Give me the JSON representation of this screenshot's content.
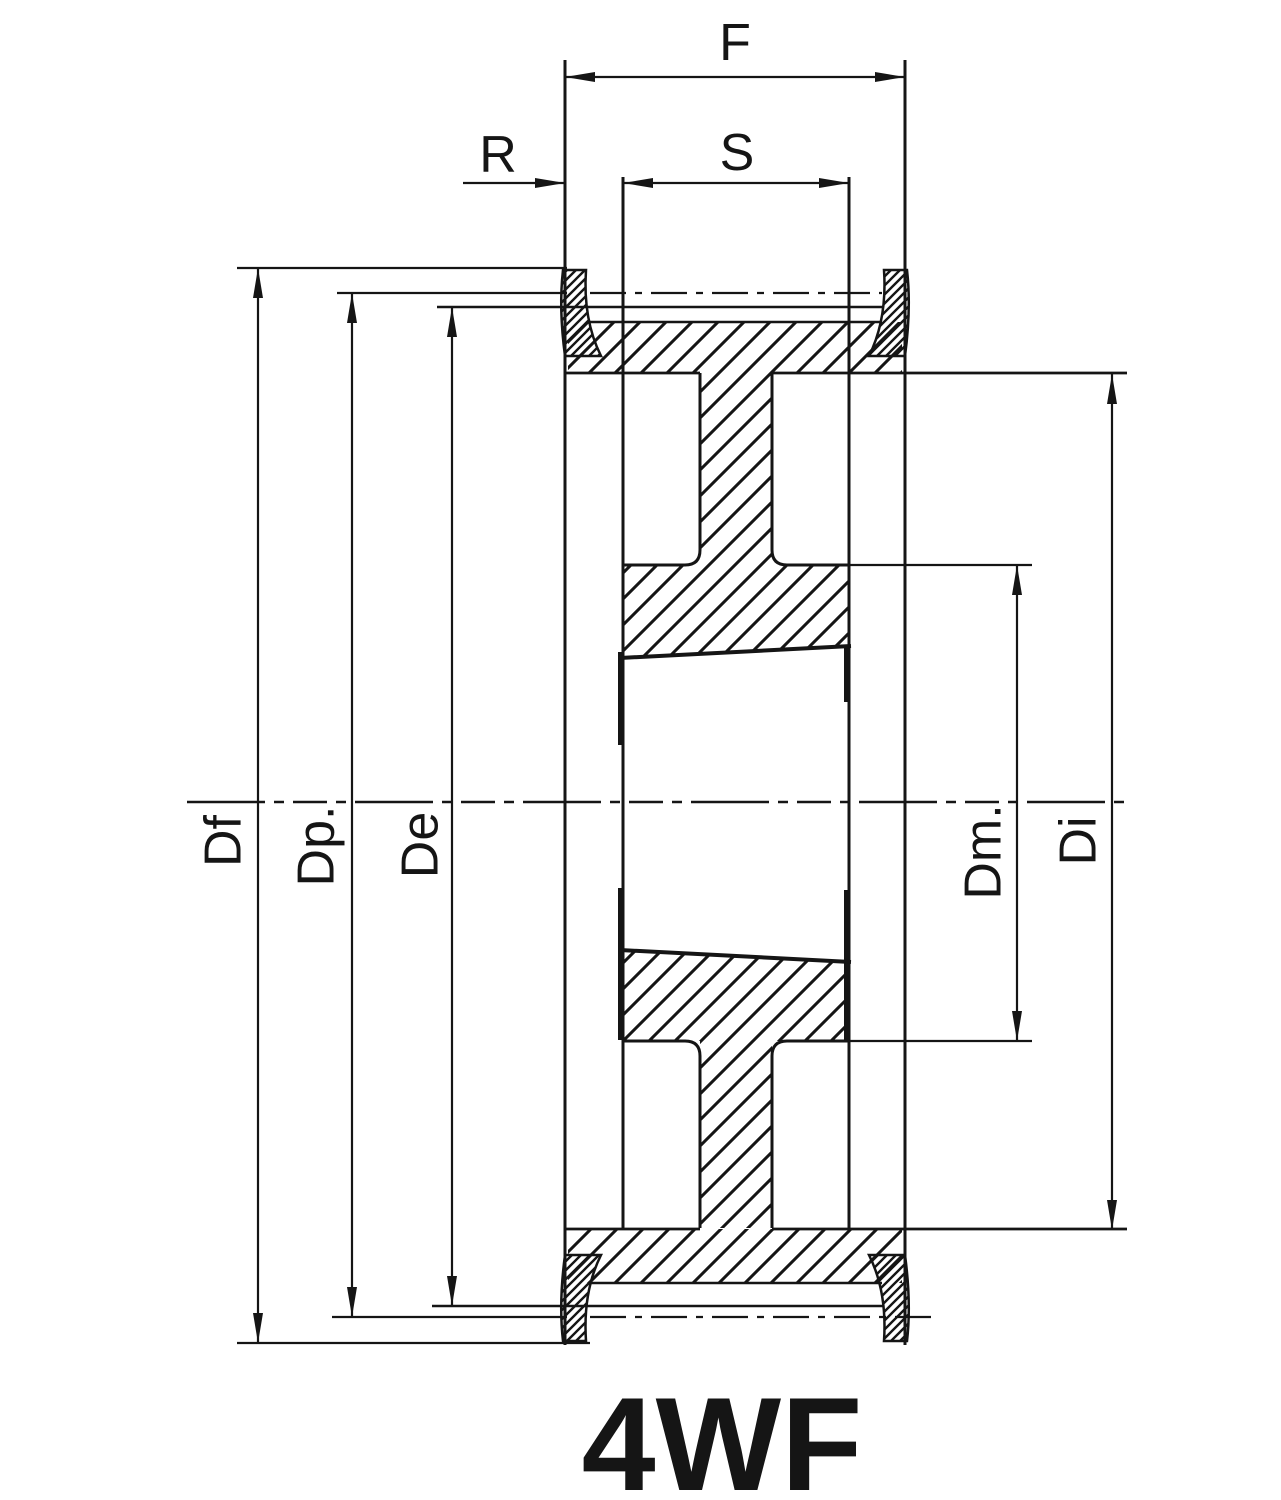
{
  "drawing": {
    "type": "technical-cross-section",
    "part_label": "4WF",
    "dim_labels": {
      "F": "F",
      "R": "R",
      "S": "S",
      "Df": "Df",
      "Dp": "Dp.",
      "De": "De",
      "Dm": "Dm.",
      "Di": "Di"
    },
    "colors": {
      "ink": "#151515",
      "background": "#ffffff"
    }
  }
}
